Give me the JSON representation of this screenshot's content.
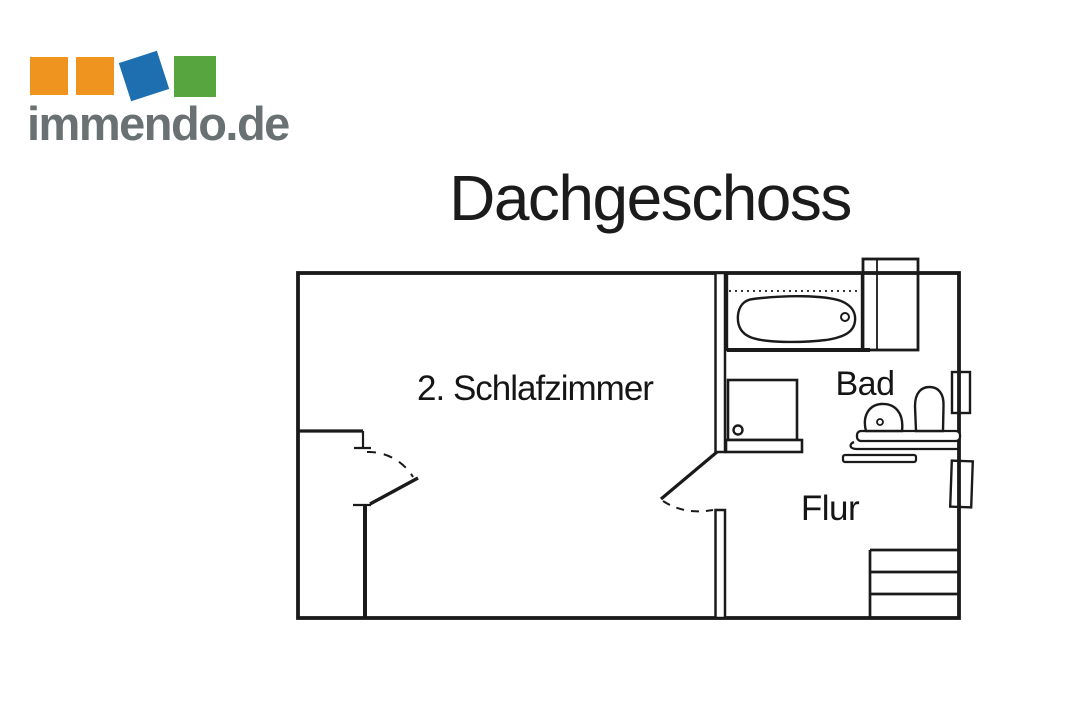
{
  "brand": {
    "name": "immendo.de",
    "colors": {
      "orange": "#EF941F",
      "blue": "#1E6FAF",
      "green": "#57A53F",
      "text_gray": "#6A7173"
    }
  },
  "page": {
    "title": "Dachgeschoss",
    "background": "#FFFFFF",
    "ink": "#1A1A1A"
  },
  "floorplan": {
    "rooms": [
      {
        "id": "schlafzimmer",
        "label": "2. Schlafzimmer"
      },
      {
        "id": "bad",
        "label": "Bad"
      },
      {
        "id": "flur",
        "label": "Flur"
      }
    ],
    "fixtures": [
      "bathtub",
      "shower",
      "washbasin",
      "toilet",
      "vanity-counter",
      "shelf",
      "hatched-shaft",
      "stairs",
      "window-upper",
      "window-lower",
      "door-bedroom-hall",
      "door-bedroom-nook"
    ]
  }
}
